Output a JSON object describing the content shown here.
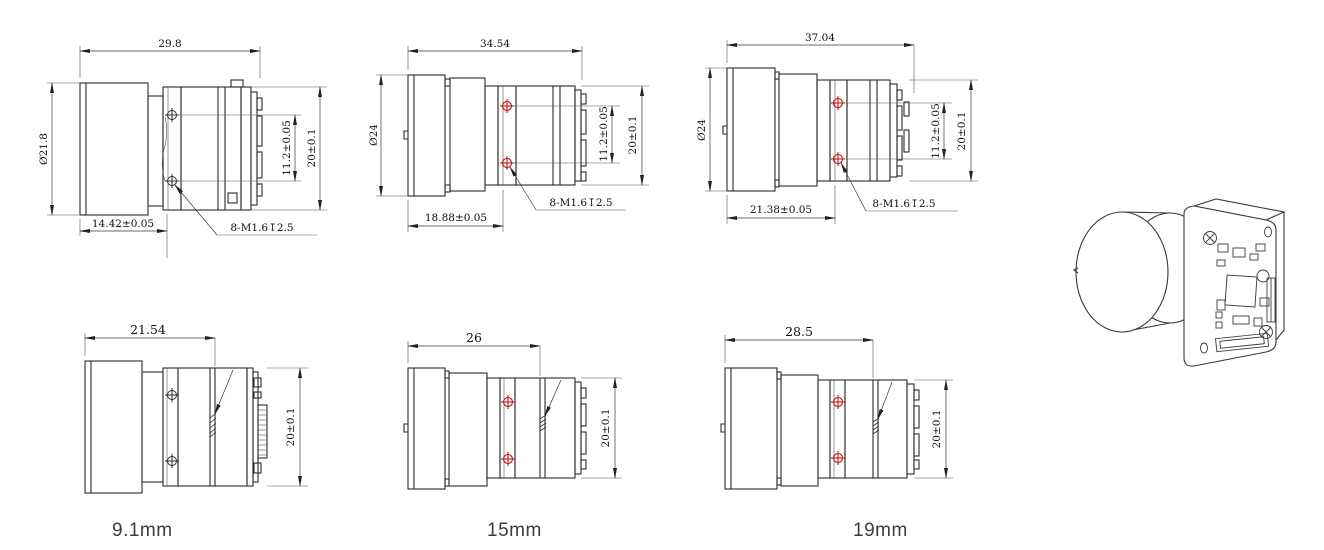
{
  "page": {
    "description": "Lens dimension drawings for board-level camera module, three focal-length variants"
  },
  "colors": {
    "line": "#2b2b2b",
    "dim_line": "#3a3a3a",
    "screw_marker_red": "#c41414",
    "label_text": "#3c3c3c"
  },
  "drawings": {
    "top_left": {
      "top_width": "29.8",
      "lens_diameter": "Ø21.8",
      "flange_length": "14.42±0.05",
      "hole_spacing": "11.2±0.05",
      "body_height": "20±0.1",
      "thread_note": "8-M1.6↧2.5"
    },
    "top_middle": {
      "top_width": "34.54",
      "lens_diameter": "Ø24",
      "flange_length": "18.88±0.05",
      "hole_spacing": "11.2±0.05",
      "body_height": "20±0.1",
      "thread_note": "8-M1.6↧2.5"
    },
    "top_right": {
      "top_width": "37.04",
      "lens_diameter": "Ø24",
      "flange_length": "21.38±0.05",
      "hole_spacing": "11.2±0.05",
      "body_height": "20±0.1",
      "thread_note": "8-M1.6↧2.5"
    },
    "bottom_left": {
      "top_width": "21.54",
      "body_height": "20±0.1",
      "label": "9.1mm"
    },
    "bottom_middle": {
      "top_width": "26",
      "body_height": "20±0.1",
      "label": "15mm"
    },
    "bottom_right": {
      "top_width": "28.5",
      "body_height": "20±0.1",
      "label": "19mm"
    }
  }
}
